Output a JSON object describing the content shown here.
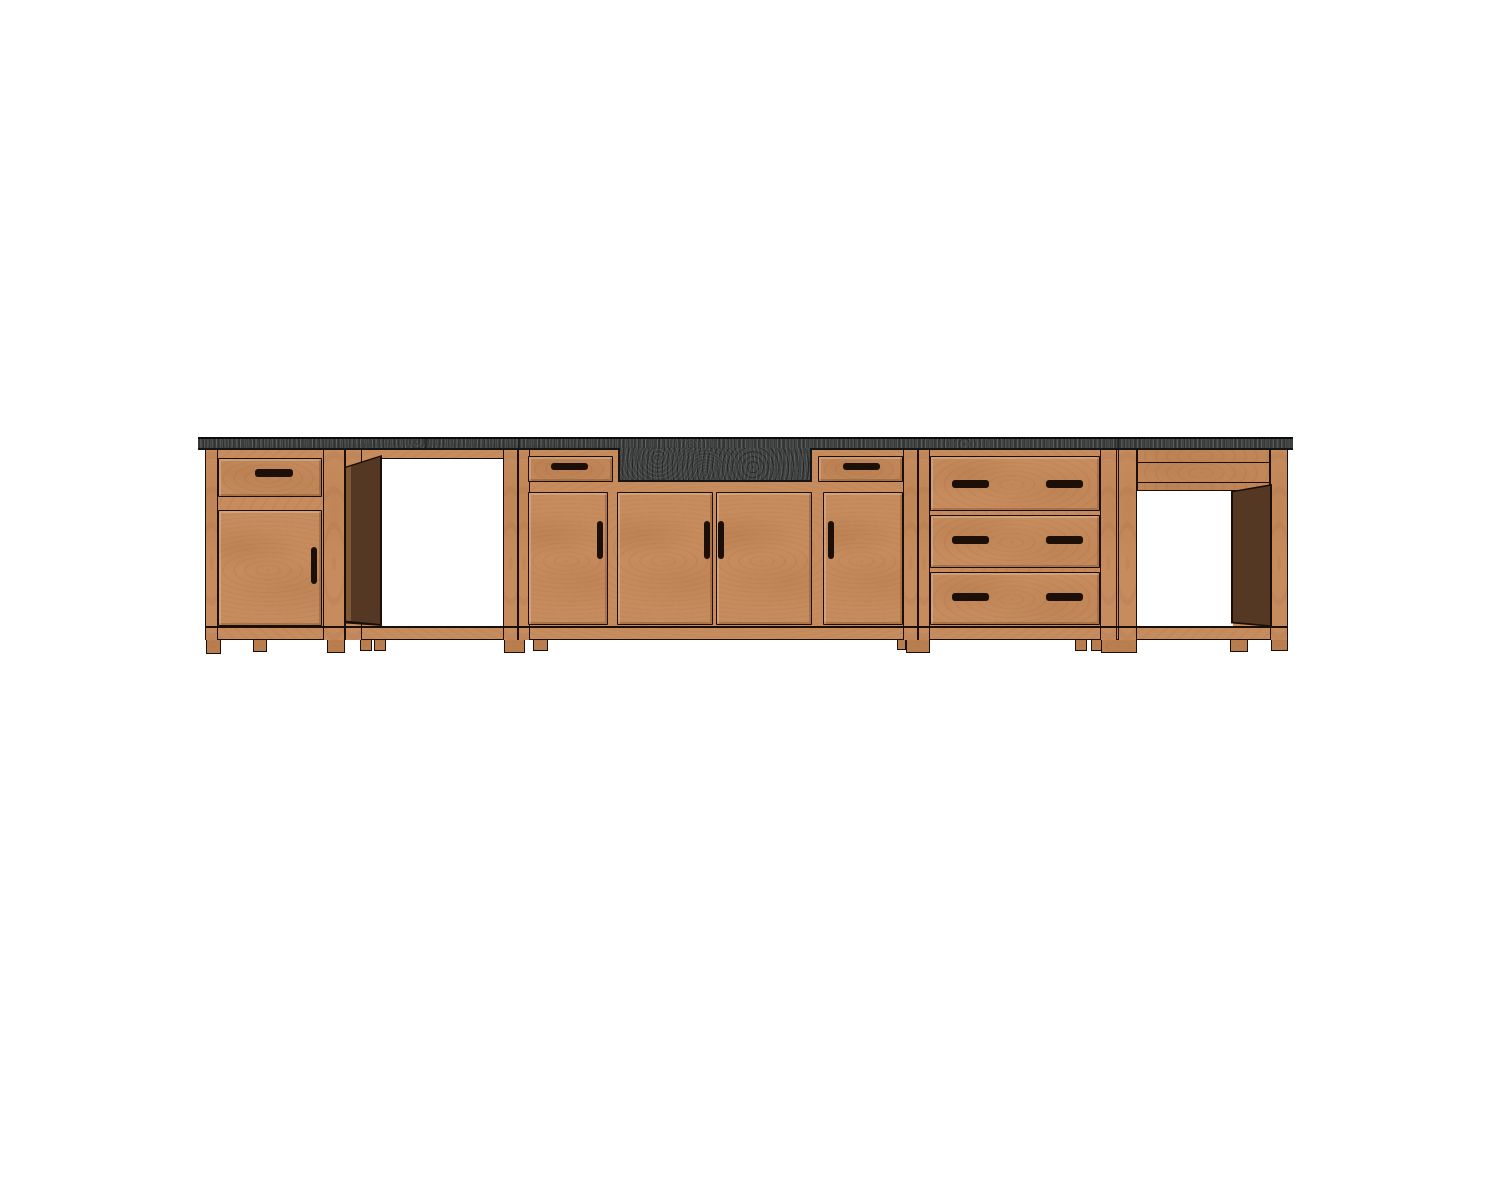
{
  "scene": {
    "description": "CAD-style front elevation render of a kitchen base-cabinet run with dark granite countertop, farmhouse sink apron, two open appliance bays, drawer-over-door cabinets, a sink base with four doors and two drawers, and a three-drawer base",
    "background": "#ffffff",
    "palette": {
      "wood": "#c78c5e",
      "line": "#1a0e06",
      "granite": "#3a3d3c",
      "interior": "#543823",
      "interior-hi": "#7c5835",
      "handle": "#1c0f07"
    },
    "units": [
      {
        "id": "unit-1",
        "label": "base cabinet with drawer over door"
      },
      {
        "id": "unit-2",
        "label": "open appliance bay with door swung open"
      },
      {
        "id": "unit-3",
        "label": "sink base with apron sink, two drawers and four doors"
      },
      {
        "id": "unit-4",
        "label": "three-drawer base cabinet"
      },
      {
        "id": "unit-5",
        "label": "open appliance bay with top rails"
      }
    ],
    "elements": [
      {
        "kind": "base",
        "name": "face-frame-base",
        "x": 205,
        "y": 449,
        "w": 1083,
        "h": 191
      },
      {
        "kind": "stile",
        "name": "stile-unit1-left",
        "x": 205,
        "y": 449,
        "w": 13,
        "h": 191
      },
      {
        "kind": "stile",
        "name": "stile-unit1-right",
        "x": 323,
        "y": 449,
        "w": 22,
        "h": 191
      },
      {
        "kind": "stile",
        "name": "post-unit2-left",
        "x": 345,
        "y": 449,
        "w": 17,
        "h": 191
      },
      {
        "kind": "stile",
        "name": "post-unit2-right",
        "x": 503,
        "y": 449,
        "w": 15,
        "h": 191
      },
      {
        "kind": "stile",
        "name": "stile-unit3-left",
        "x": 518,
        "y": 449,
        "w": 12,
        "h": 191
      },
      {
        "kind": "stile",
        "name": "stile-unit3-right",
        "x": 903,
        "y": 449,
        "w": 15,
        "h": 191
      },
      {
        "kind": "stile",
        "name": "stile-unit4-left",
        "x": 918,
        "y": 449,
        "w": 12,
        "h": 191
      },
      {
        "kind": "stile",
        "name": "stile-unit4-right",
        "x": 1100,
        "y": 449,
        "w": 17,
        "h": 191
      },
      {
        "kind": "stile",
        "name": "stile-unit5-left",
        "x": 1118,
        "y": 449,
        "w": 19,
        "h": 191
      },
      {
        "kind": "stile",
        "name": "stile-unit5-right",
        "x": 1270,
        "y": 449,
        "w": 18,
        "h": 191
      },
      {
        "kind": "hline",
        "name": "bottom-rail-top-edge",
        "x": 205,
        "y": 626,
        "w": 1083,
        "h": 1.5
      },
      {
        "kind": "band",
        "name": "unit5-top-rail",
        "x": 1137,
        "y": 449,
        "w": 133,
        "h": 14
      },
      {
        "kind": "band",
        "name": "unit5-second-rail",
        "x": 1137,
        "y": 462,
        "w": 133,
        "h": 21
      },
      {
        "kind": "strip",
        "name": "unit5-interior-top-strip",
        "x": 1137,
        "y": 482,
        "w": 133,
        "h": 9
      },
      {
        "kind": "opening",
        "name": "unit2-appliance-opening",
        "x": 381,
        "y": 458,
        "w": 122,
        "h": 169
      },
      {
        "kind": "opening",
        "name": "unit5-appliance-opening",
        "x": 1137,
        "y": 490,
        "w": 96,
        "h": 137
      },
      {
        "kind": "interior-back",
        "name": "unit2-open-door-outline",
        "x": 344,
        "y": 455,
        "w": 38,
        "h": 171,
        "clip": "polygon(0 7%, 100% 0, 100% 100%, 0 98.5%)"
      },
      {
        "kind": "interior-door",
        "name": "unit2-open-door",
        "x": 346,
        "y": 457,
        "w": 34,
        "h": 167,
        "clip": "polygon(0 6.5%, 100% 0, 100% 100%, 0 98%)"
      },
      {
        "kind": "interior-back",
        "name": "unit5-interior-outline",
        "x": 1231,
        "y": 484,
        "w": 41,
        "h": 143,
        "clip": "polygon(0 5%, 100% 0, 100% 100%, 0 97.5%)"
      },
      {
        "kind": "interior-panel",
        "name": "unit5-interior-side-panel",
        "x": 1233,
        "y": 486,
        "w": 37,
        "h": 140,
        "clip": "polygon(0 4.5%, 100% 0, 100% 99.5%, 0 97%)"
      },
      {
        "kind": "front",
        "name": "unit1-drawer-front",
        "x": 218,
        "y": 458,
        "w": 104,
        "h": 39
      },
      {
        "kind": "front",
        "name": "unit1-door",
        "x": 218,
        "y": 510,
        "w": 104,
        "h": 116
      },
      {
        "kind": "front",
        "name": "unit3-drawer-left",
        "x": 528,
        "y": 456,
        "w": 85,
        "h": 26
      },
      {
        "kind": "front",
        "name": "unit3-drawer-right",
        "x": 818,
        "y": 456,
        "w": 85,
        "h": 26
      },
      {
        "kind": "front",
        "name": "unit3-door-left",
        "x": 528,
        "y": 492,
        "w": 80,
        "h": 133
      },
      {
        "kind": "front",
        "name": "unit3-door-center-left",
        "x": 617,
        "y": 492,
        "w": 96,
        "h": 133
      },
      {
        "kind": "front",
        "name": "unit3-door-center-right",
        "x": 716,
        "y": 492,
        "w": 96,
        "h": 133
      },
      {
        "kind": "front",
        "name": "unit3-door-right",
        "x": 823,
        "y": 492,
        "w": 80,
        "h": 133
      },
      {
        "kind": "front",
        "name": "unit4-drawer-1",
        "x": 930,
        "y": 456,
        "w": 170,
        "h": 55
      },
      {
        "kind": "front",
        "name": "unit4-drawer-2",
        "x": 930,
        "y": 515,
        "w": 170,
        "h": 53
      },
      {
        "kind": "front",
        "name": "unit4-drawer-3",
        "x": 930,
        "y": 572,
        "w": 170,
        "h": 53
      },
      {
        "kind": "handle",
        "name": "unit1-drawer-handle",
        "x": 255,
        "y": 469,
        "w": 38,
        "h": 8
      },
      {
        "kind": "handle",
        "name": "unit1-door-handle",
        "x": 311,
        "y": 547,
        "w": 6,
        "h": 37
      },
      {
        "kind": "handle",
        "name": "unit3-drawer-left-handle",
        "x": 551,
        "y": 463,
        "w": 37,
        "h": 7
      },
      {
        "kind": "handle",
        "name": "unit3-drawer-right-handle",
        "x": 843,
        "y": 463,
        "w": 37,
        "h": 7
      },
      {
        "kind": "handle",
        "name": "unit3-door-left-handle",
        "x": 597,
        "y": 521,
        "w": 6,
        "h": 38
      },
      {
        "kind": "handle",
        "name": "unit3-door-center-left-handle",
        "x": 704,
        "y": 521,
        "w": 6,
        "h": 38
      },
      {
        "kind": "handle",
        "name": "unit3-door-center-right-handle",
        "x": 718,
        "y": 521,
        "w": 6,
        "h": 38
      },
      {
        "kind": "handle",
        "name": "unit3-door-right-handle",
        "x": 828,
        "y": 521,
        "w": 6,
        "h": 38
      },
      {
        "kind": "handle",
        "name": "unit4-drawer1-handle-left",
        "x": 952,
        "y": 480,
        "w": 37,
        "h": 8
      },
      {
        "kind": "handle",
        "name": "unit4-drawer1-handle-right",
        "x": 1046,
        "y": 480,
        "w": 37,
        "h": 8
      },
      {
        "kind": "handle",
        "name": "unit4-drawer2-handle-left",
        "x": 952,
        "y": 536,
        "w": 37,
        "h": 8
      },
      {
        "kind": "handle",
        "name": "unit4-drawer2-handle-right",
        "x": 1046,
        "y": 536,
        "w": 37,
        "h": 8
      },
      {
        "kind": "handle",
        "name": "unit4-drawer3-handle-left",
        "x": 952,
        "y": 593,
        "w": 37,
        "h": 8
      },
      {
        "kind": "handle",
        "name": "unit4-drawer3-handle-right",
        "x": 1046,
        "y": 593,
        "w": 37,
        "h": 8
      },
      {
        "kind": "leg",
        "name": "unit1-left-leg",
        "x": 206,
        "y": 640,
        "w": 15,
        "h": 14
      },
      {
        "kind": "foot",
        "name": "unit1-center-foot",
        "x": 253,
        "y": 640,
        "w": 14,
        "h": 12
      },
      {
        "kind": "leg",
        "name": "unit1-right-leg",
        "x": 327,
        "y": 640,
        "w": 18,
        "h": 13
      },
      {
        "kind": "foot",
        "name": "unit2-foot-a",
        "x": 360,
        "y": 640,
        "w": 12,
        "h": 11
      },
      {
        "kind": "foot",
        "name": "unit2-foot-b",
        "x": 374,
        "y": 640,
        "w": 12,
        "h": 11
      },
      {
        "kind": "leg",
        "name": "unit2-right-leg",
        "x": 504,
        "y": 640,
        "w": 21,
        "h": 13
      },
      {
        "kind": "foot",
        "name": "unit3-left-foot",
        "x": 533,
        "y": 640,
        "w": 15,
        "h": 11
      },
      {
        "kind": "foot",
        "name": "unit3-right-foot",
        "x": 897,
        "y": 640,
        "w": 9,
        "h": 10
      },
      {
        "kind": "leg",
        "name": "unit3-right-leg",
        "x": 906,
        "y": 640,
        "w": 24,
        "h": 13
      },
      {
        "kind": "foot",
        "name": "unit4-foot-a",
        "x": 1075,
        "y": 640,
        "w": 12,
        "h": 11
      },
      {
        "kind": "foot",
        "name": "unit4-foot-b",
        "x": 1091,
        "y": 640,
        "w": 12,
        "h": 11
      },
      {
        "kind": "leg",
        "name": "unit4-right-leg",
        "x": 1101,
        "y": 640,
        "w": 36,
        "h": 13
      },
      {
        "kind": "foot",
        "name": "unit5-foot",
        "x": 1230,
        "y": 640,
        "w": 18,
        "h": 12
      },
      {
        "kind": "leg",
        "name": "unit5-right-leg",
        "x": 1271,
        "y": 640,
        "w": 17,
        "h": 11
      },
      {
        "kind": "counter",
        "name": "granite-countertop",
        "x": 198,
        "y": 437,
        "w": 1095,
        "h": 13
      },
      {
        "kind": "apron",
        "name": "farmhouse-sink-apron",
        "x": 618,
        "y": 448,
        "w": 194,
        "h": 34
      },
      {
        "kind": "seam",
        "name": "countertop-seam-1",
        "x": 425,
        "y": 439,
        "w": 1.5,
        "h": 9
      },
      {
        "kind": "seam",
        "name": "countertop-seam-2",
        "x": 518,
        "y": 439,
        "w": 1.5,
        "h": 9
      },
      {
        "kind": "seam",
        "name": "countertop-seam-3",
        "x": 1117,
        "y": 439,
        "w": 1.5,
        "h": 9
      }
    ]
  }
}
